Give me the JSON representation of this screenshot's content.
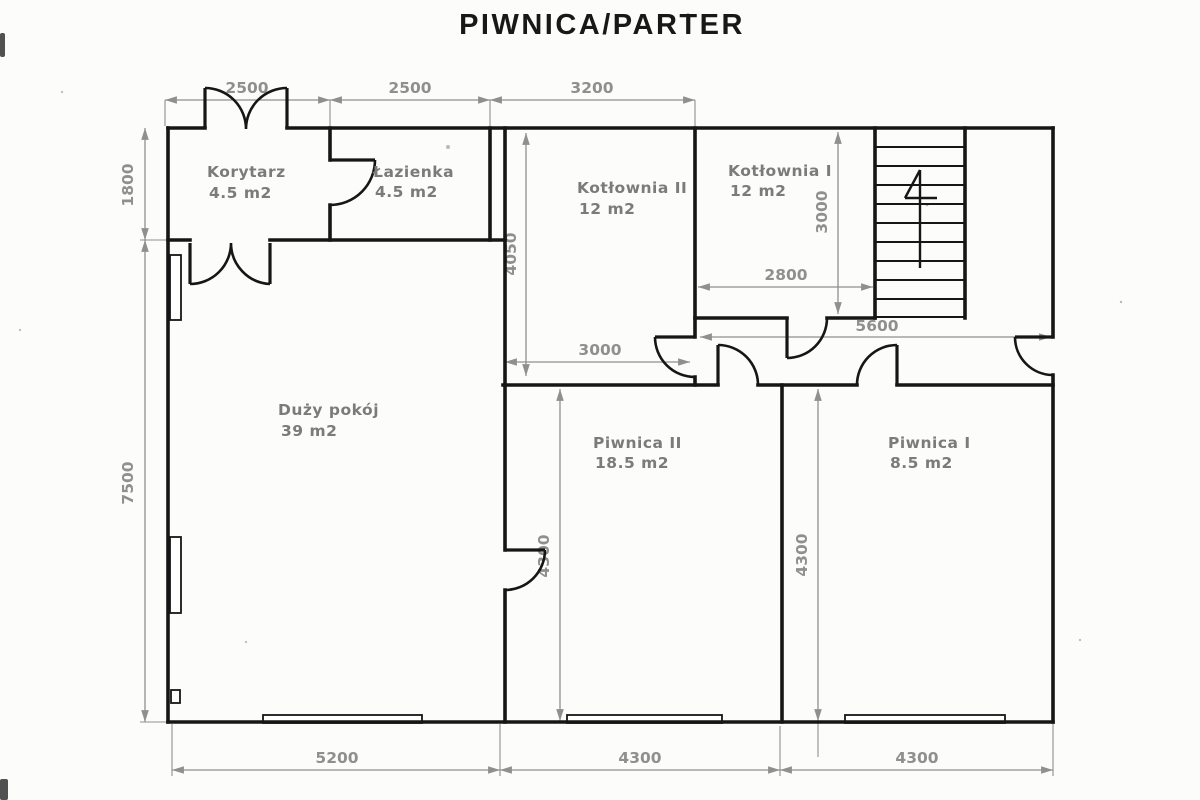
{
  "title": "PIWNICA/PARTER",
  "floor_plan": {
    "rooms": [
      {
        "id": "korytarz",
        "name": "Korytarz",
        "area": "4.5 m2"
      },
      {
        "id": "lazienka",
        "name": "Łazienka",
        "area": "4.5 m2"
      },
      {
        "id": "kotlownia-2",
        "name": "Kotłownia II",
        "area": "12 m2"
      },
      {
        "id": "kotlownia-1",
        "name": "Kotłownia I",
        "area": "12 m2"
      },
      {
        "id": "duzy-pokoj",
        "name": "Duży pokój",
        "area": "39 m2"
      },
      {
        "id": "piwnica-2",
        "name": "Piwnica II",
        "area": "18.5 m2"
      },
      {
        "id": "piwnica-1",
        "name": "Piwnica I",
        "area": "8.5 m2"
      }
    ],
    "dims": {
      "top_2500_a": "2500",
      "top_2500_b": "2500",
      "top_3200": "3200",
      "left_1800": "1800",
      "left_7500": "7500",
      "bottom_5200": "5200",
      "bottom_4300_a": "4300",
      "bottom_4300_b": "4300",
      "inner_4050": "4050",
      "inner_3000_h": "3000",
      "inner_2800": "2800",
      "inner_3000_v": "3000",
      "inner_5600": "5600",
      "inner_4300_a": "4300",
      "inner_4300_b": "4300"
    }
  },
  "colors": {
    "wall": "#161616",
    "dimension_line": "#8f8f8f",
    "label_text": "#7b7b7b",
    "background": "#fcfcfa"
  }
}
